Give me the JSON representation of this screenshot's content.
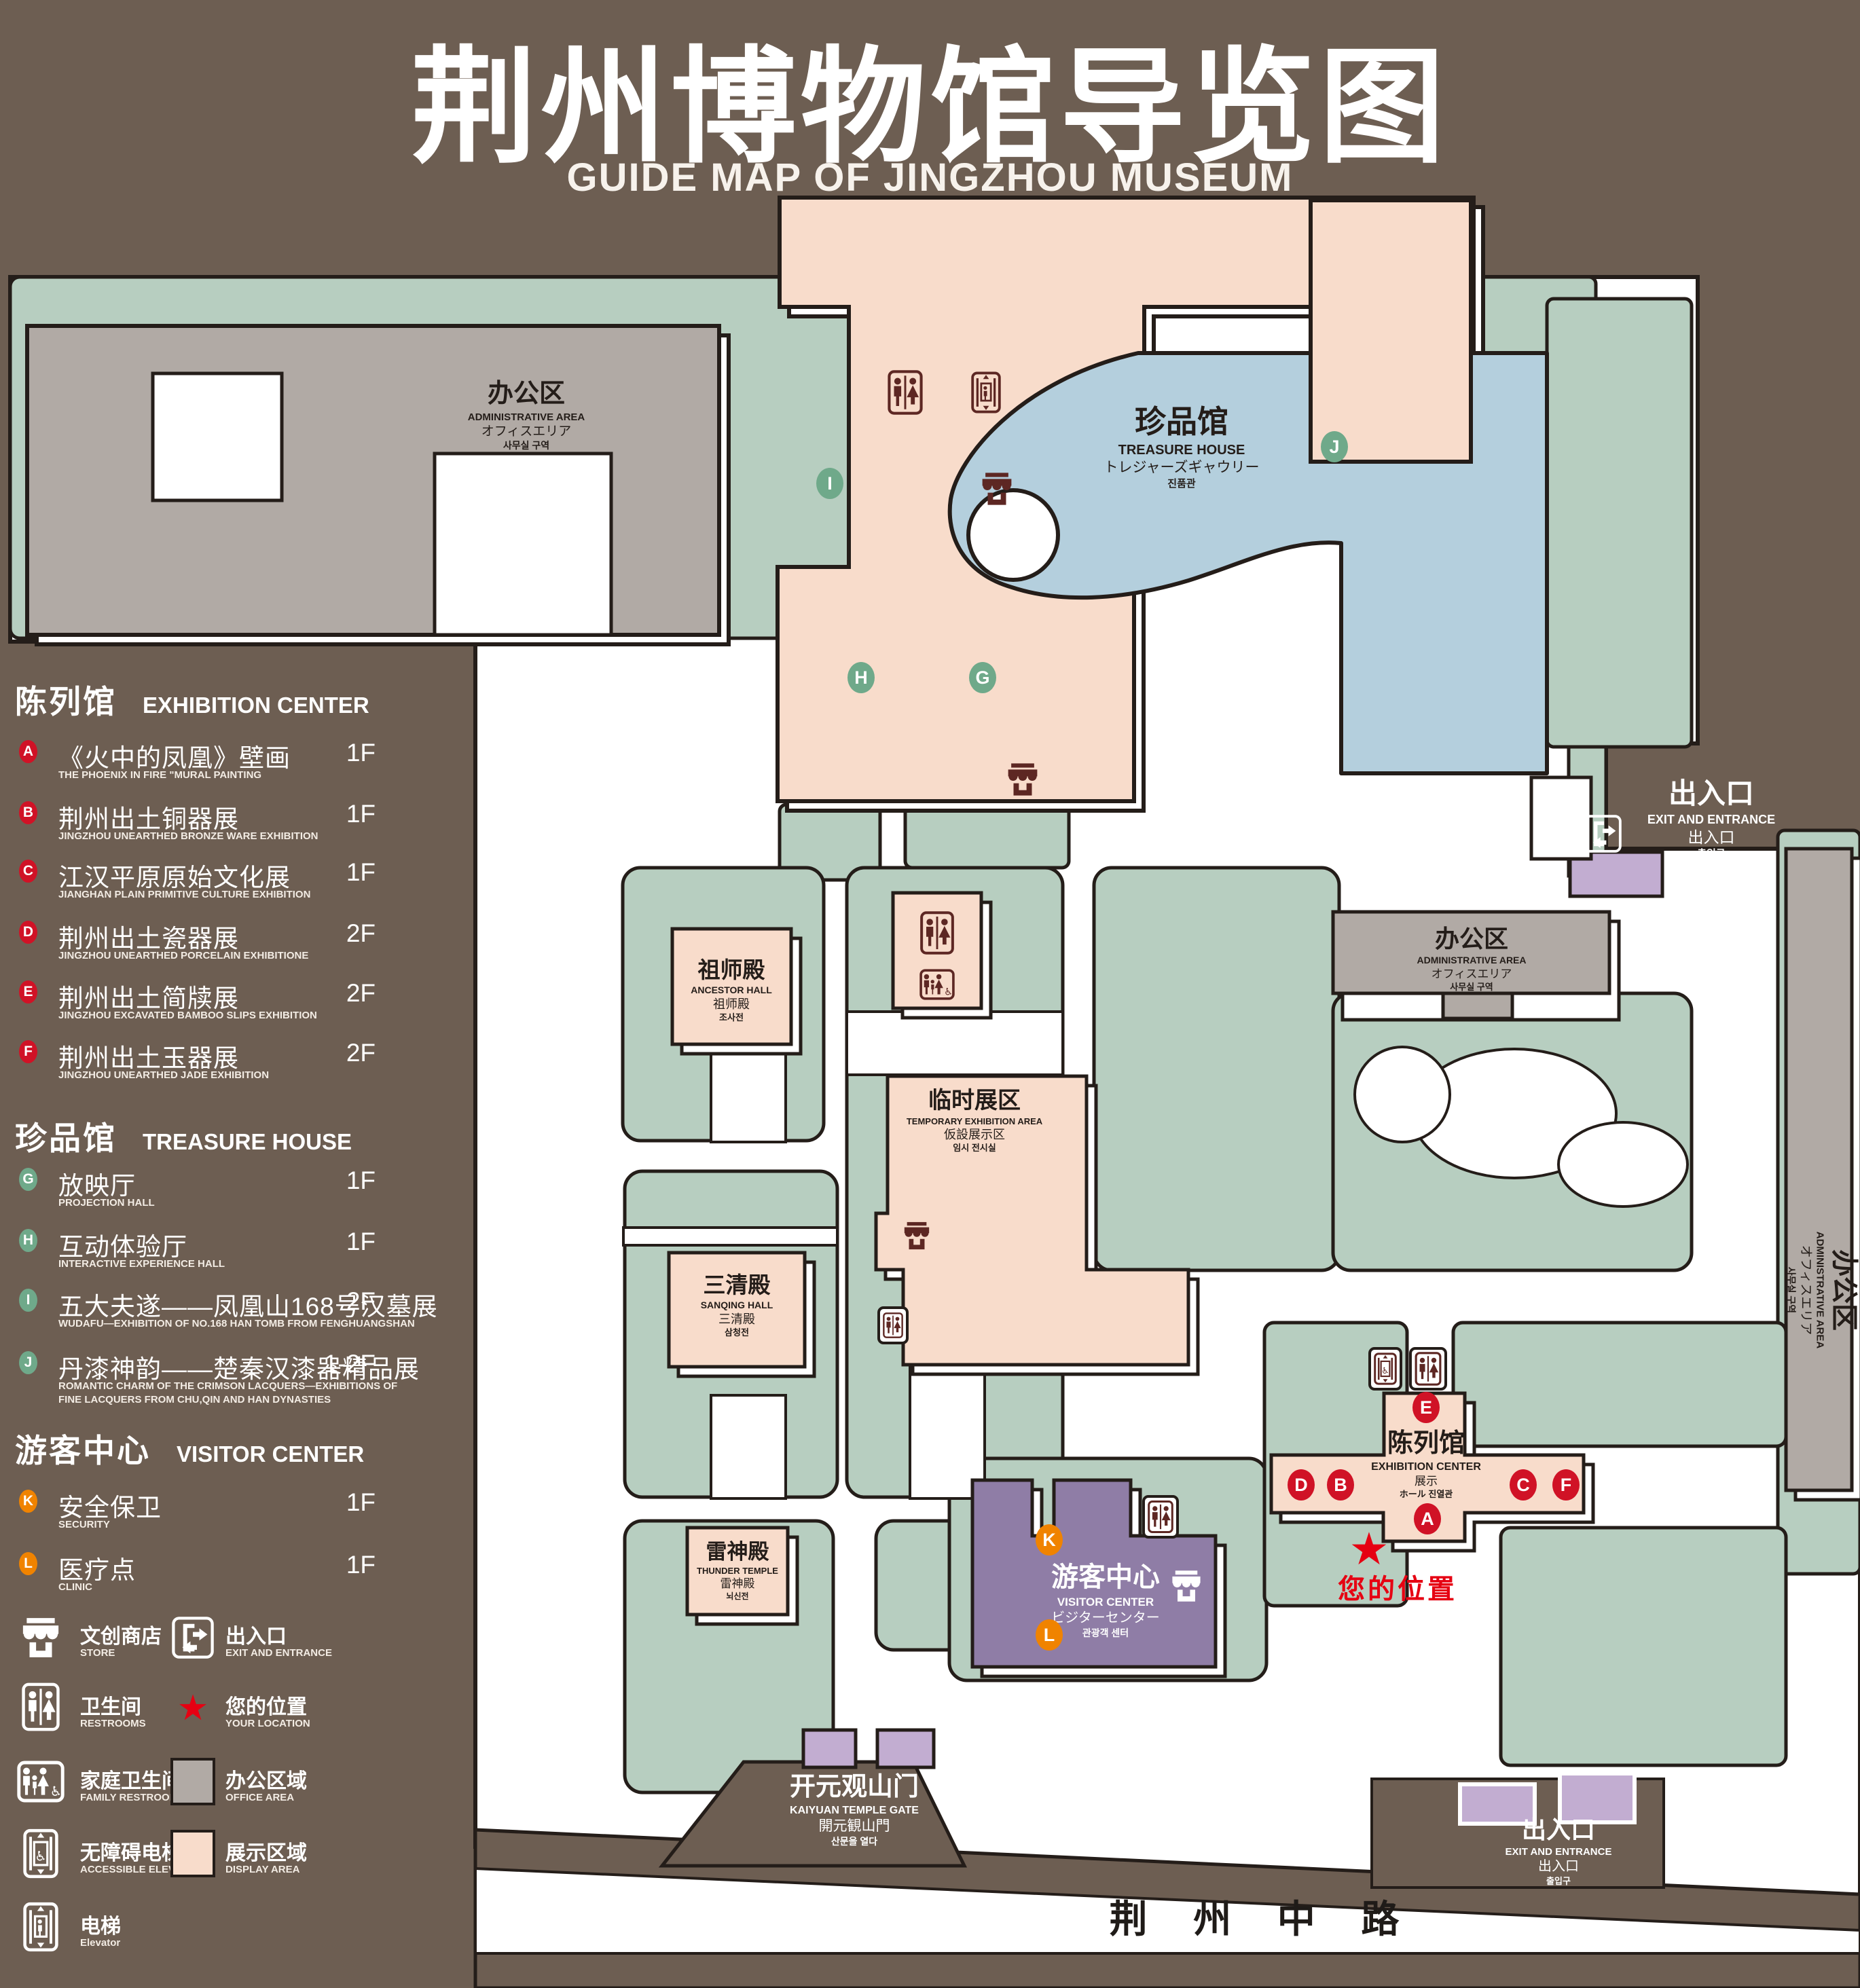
{
  "colors": {
    "background": "#6d5e52",
    "lawn": "#b7cec0",
    "display_area": "#f8dccb",
    "office_area": "#b1aaa5",
    "visitor_center": "#8f7da6",
    "entrance_purple": "#c2add1",
    "pond": "#b4cfdd",
    "outline": "#241d19",
    "badge_red": "#d01226",
    "badge_green": "#6fa98a",
    "badge_orange": "#f08300",
    "icon_dark": "#5d2723",
    "highlight_red": "#e60012"
  },
  "title": {
    "zh": "荆州博物馆导览图",
    "en": "GUIDE MAP OF JINGZHOU MUSEUM"
  },
  "legend": {
    "sections": [
      {
        "zh": "陈列馆",
        "en": "EXHIBITION CENTER",
        "items": [
          {
            "letter": "A",
            "zh": "《火中的凤凰》壁画",
            "en": "THE PHOENIX IN FIRE \"MURAL PAINTING",
            "floor": "1F"
          },
          {
            "letter": "B",
            "zh": "荆州出土铜器展",
            "en": "JINGZHOU UNEARTHED BRONZE WARE EXHIBITION",
            "floor": "1F"
          },
          {
            "letter": "C",
            "zh": "江汉平原原始文化展",
            "en": "JIANGHAN PLAIN PRIMITIVE CULTURE EXHIBITION",
            "floor": "1F"
          },
          {
            "letter": "D",
            "zh": "荆州出土瓷器展",
            "en": "JINGZHOU UNEARTHED PORCELAIN EXHIBITIONE",
            "floor": "2F"
          },
          {
            "letter": "E",
            "zh": "荆州出土简牍展",
            "en": "JINGZHOU EXCAVATED BAMBOO SLIPS EXHIBITION",
            "floor": "2F"
          },
          {
            "letter": "F",
            "zh": "荆州出土玉器展",
            "en": "JINGZHOU UNEARTHED JADE EXHIBITION",
            "floor": "2F"
          }
        ]
      },
      {
        "zh": "珍品馆",
        "en": "TREASURE HOUSE",
        "items": [
          {
            "letter": "G",
            "zh": "放映厅",
            "en": "PROJECTION HALL",
            "floor": "1F"
          },
          {
            "letter": "H",
            "zh": "互动体验厅",
            "en": "INTERACTIVE EXPERIENCE HALL",
            "floor": "1F"
          },
          {
            "letter": "I",
            "zh": "五大夫遂——凤凰山168号汉墓展",
            "en": "WUDAFU—EXHIBITION OF NO.168 HAN TOMB FROM FENGHUANGSHAN",
            "floor": "2F"
          },
          {
            "letter": "J",
            "zh": "丹漆神韵——楚秦汉漆器精品展",
            "en": "ROMANTIC CHARM OF THE CRIMSON LACQUERS—EXHIBITIONS OF FINE LACQUERS FROM CHU,QIN AND HAN DYNASTIES",
            "floor": "1-2F"
          }
        ]
      },
      {
        "zh": "游客中心",
        "en": "VISITOR CENTER",
        "items": [
          {
            "letter": "K",
            "zh": "安全保卫",
            "en": "SECURITY",
            "floor": "1F"
          },
          {
            "letter": "L",
            "zh": "医疗点",
            "en": "CLINIC",
            "floor": "1F"
          }
        ]
      }
    ],
    "symbols": [
      {
        "zh": "文创商店",
        "en": "STORE"
      },
      {
        "zh": "出入口",
        "en": "EXIT AND ENTRANCE"
      },
      {
        "zh": "卫生间",
        "en": "RESTROOMS"
      },
      {
        "zh": "您的位置",
        "en": "YOUR LOCATION"
      },
      {
        "zh": "家庭卫生间",
        "en": "FAMILY RESTROOMS"
      },
      {
        "zh": "办公区域",
        "en": "OFFICE AREA"
      },
      {
        "zh": "无障碍电梯",
        "en": "ACCESSIBLE ELEVATOR"
      },
      {
        "zh": "展示区域",
        "en": "DISPLAY AREA"
      },
      {
        "zh": "电梯",
        "en": "Elevator"
      }
    ]
  },
  "map": {
    "admin": {
      "zh": "办公区",
      "en": "ADMINISTRATIVE AREA",
      "jp": "オフィスエリア",
      "kr": "사무실 구역"
    },
    "treasure": {
      "zh": "珍品馆",
      "en": "TREASURE HOUSE",
      "jp": "トレジャーズギャウリー",
      "kr": "진품관"
    },
    "ancestor": {
      "zh": "祖师殿",
      "en": "ANCESTOR HALL",
      "zh2": "祖师殿",
      "kr": "조사전"
    },
    "temporary": {
      "zh": "临时展区",
      "en": "TEMPORARY EXHIBITION AREA",
      "jp": "仮設展示区",
      "kr": "임시 전시실"
    },
    "sanqing": {
      "zh": "三清殿",
      "en": "SANQING HALL",
      "zh2": "三清殿",
      "kr": "삼청전"
    },
    "thunder": {
      "zh": "雷神殿",
      "en": "THUNDER TEMPLE",
      "zh2": "雷神殿",
      "kr": "뇌신전"
    },
    "visitor": {
      "zh": "游客中心",
      "en": "VISITOR CENTER",
      "jp": "ビジターセンター",
      "kr": "관광객 센터"
    },
    "exhibition": {
      "zh": "陈列馆",
      "en": "EXHIBITION CENTER",
      "zh2": "展示",
      "kr": "ホール 진열관"
    },
    "gate": {
      "zh": "开元观山门",
      "en": "KAIYUAN TEMPLE GATE",
      "jp": "開元観山門",
      "kr": "산문을 열다"
    },
    "exit": {
      "zh": "出入口",
      "en": "EXIT AND ENTRANCE",
      "zh2": "出入口",
      "kr": "출입구"
    },
    "road": "荆 州 中 路",
    "your_location": "您的位置",
    "star_glyph": "★"
  }
}
